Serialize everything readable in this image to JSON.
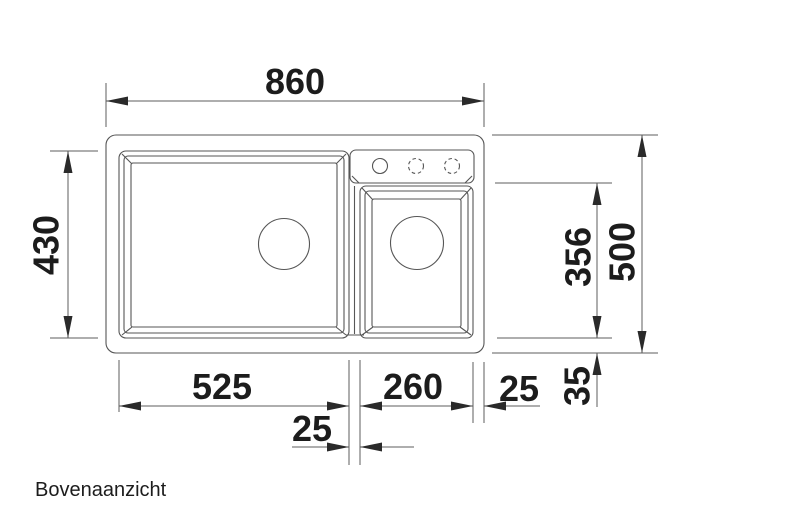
{
  "page": {
    "caption": "Bovenaanzicht",
    "background": "#ffffff"
  },
  "drawing": {
    "subject": "double-bowl-sink-top-view",
    "unit": "mm",
    "line_color": "#565656",
    "text_color": "#1c1c1c",
    "faucet_holes": {
      "drilled_count": 1,
      "optional_dashed_count": 2
    },
    "dimensions": {
      "overall_width": "860",
      "overall_depth": "500",
      "main_bowl_depth": "430",
      "deck_to_bowl_bottom": "356",
      "main_bowl_width": "525",
      "center_divider": "25",
      "small_bowl_width": "260",
      "right_edge_offset": "25",
      "bottom_edge_offset": "35"
    }
  }
}
